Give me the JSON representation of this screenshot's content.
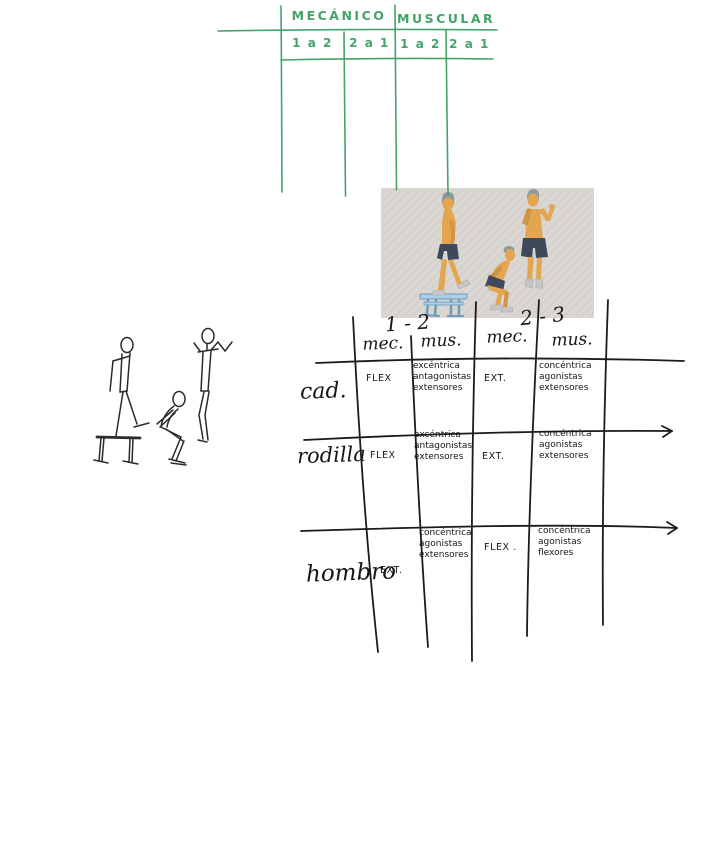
{
  "colors": {
    "green_ink": "#43a368",
    "black_ink": "#1b1b1b",
    "photo_bg": "#d9d6d2",
    "skin": "#e3a64f",
    "skin_shadow": "#cf9544",
    "hair": "#8d99a1",
    "shorts": "#3e4a5c",
    "shoes": "#c5c6c8",
    "bench": "#a9cee6",
    "bench_outline": "#6f9ab8"
  },
  "green_table": {
    "groups": [
      "MECÁNICO",
      "MUSCULAR"
    ],
    "cols": [
      "1 a 2",
      "2 a 1",
      "1 a 2",
      "2 a 1"
    ]
  },
  "notes_table": {
    "groups": [
      "1 - 2",
      "2 - 3"
    ],
    "cols": [
      "mec.",
      "mus.",
      "mec.",
      "mus."
    ],
    "rows": [
      {
        "label": "cad.",
        "cells": [
          "FLEX",
          "excéntrica antagonistas extensores",
          "EXT.",
          "concéntrica agonistas extensores"
        ]
      },
      {
        "label": "rodilla",
        "cells": [
          "FLEX",
          "excéntrica antagonistas extensores",
          "EXT.",
          "concéntrica agonistas extensores"
        ]
      },
      {
        "label": "hombro",
        "cells": [
          "EXT.",
          "concéntrica agonistas extensores",
          "FLEX .",
          "concéntrica agonistas flexores"
        ]
      }
    ]
  }
}
